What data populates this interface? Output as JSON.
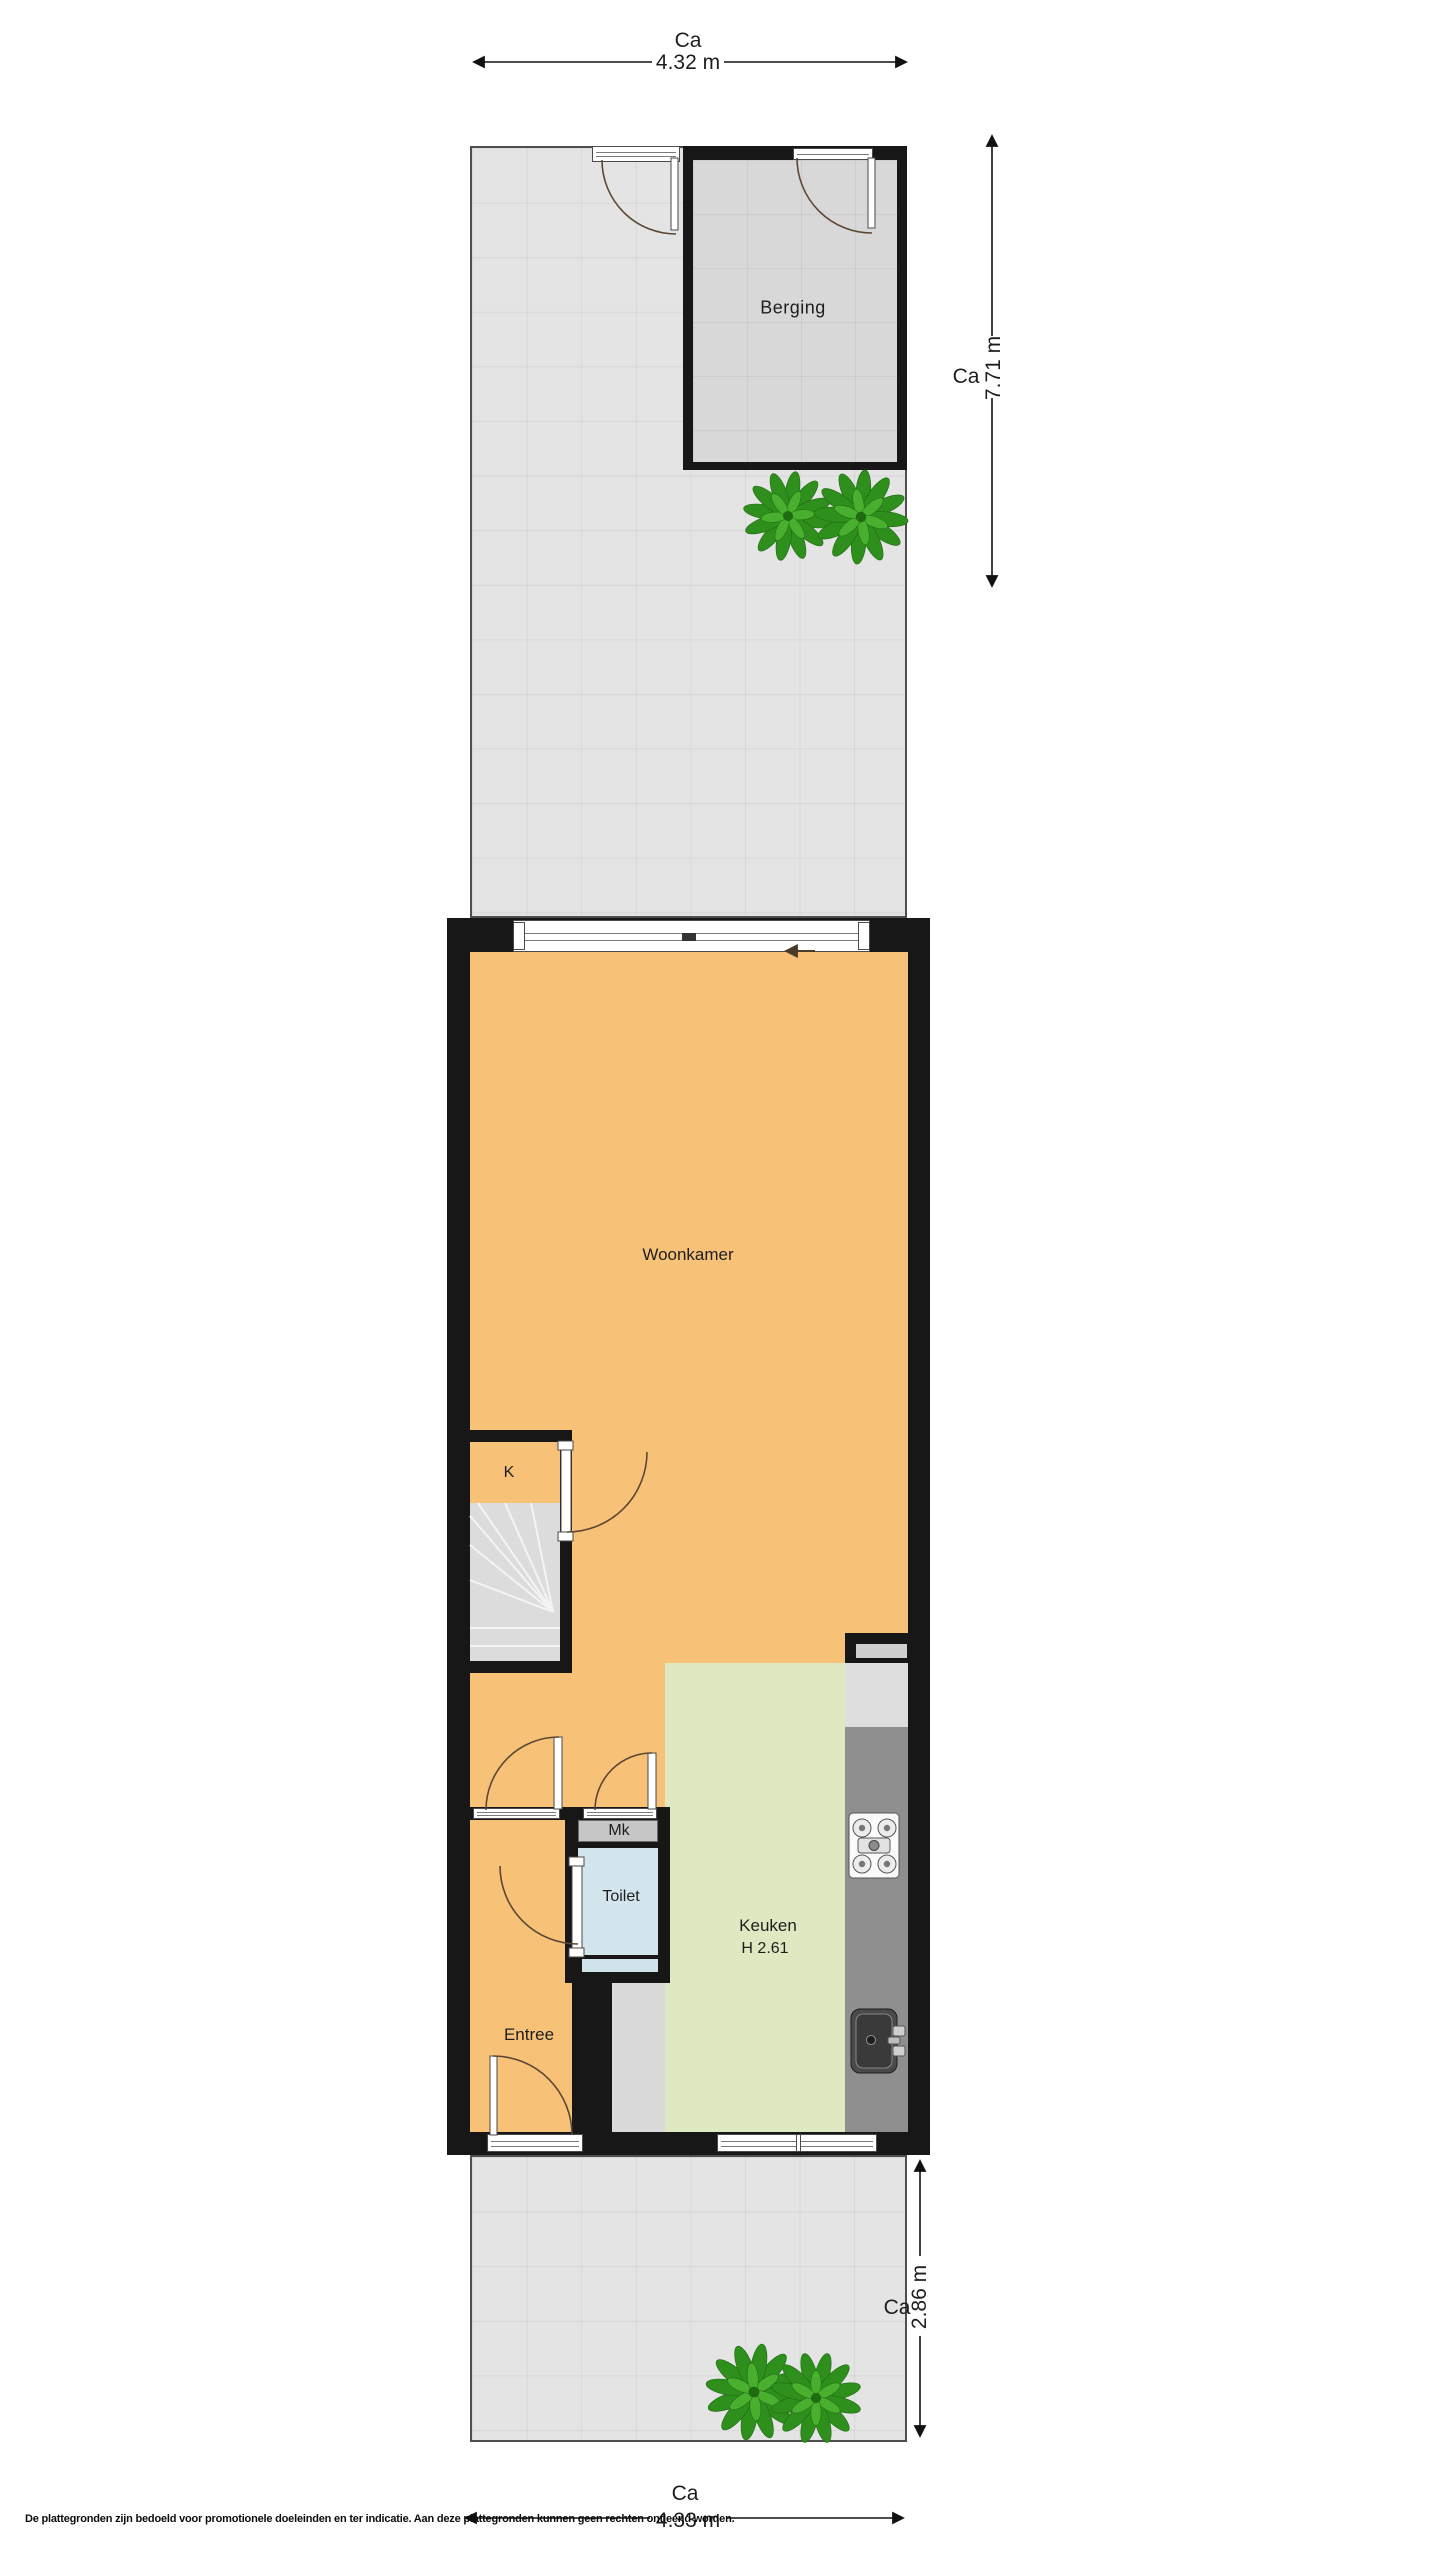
{
  "rooms": {
    "berging": "Berging",
    "woonkamer": "Woonkamer",
    "kast": "K",
    "meterkast": "Mk",
    "toilet": "Toilet",
    "keuken": "Keuken",
    "keuken_hoogte": "H 2.61",
    "entree": "Entree"
  },
  "dimensions": {
    "garden_top_width": {
      "prefix": "Ca",
      "value": "4.32 m"
    },
    "garden_top_depth": {
      "prefix": "Ca",
      "value": "7.71 m"
    },
    "garden_bottom_depth": {
      "prefix": "Ca",
      "value": "2.86 m"
    },
    "garden_bottom_width": {
      "prefix": "Ca",
      "value": "4.33 m"
    }
  },
  "disclaimer": "De plattegronden zijn bedoeld voor promotionele doeleinden en ter indicatie. Aan deze plattegronden kunnen geen rechten ontleend worden.",
  "colors": {
    "wall": "#171717",
    "living": "#F7C278",
    "kitchen": "#DFE9C1",
    "toilet_floor": "#D2E4EC",
    "garden_tile": "#E4E4E4",
    "berging_floor": "#D8D8D8",
    "stairs": "#DCDCDC",
    "hall_floor": "#DADADA",
    "meter_cupboard": "#C6C6C6",
    "counter": "#8F8F8F",
    "appliance": "#DEDEDE",
    "plant_dark": "#1E6B10",
    "plant_mid": "#2F8F1D",
    "plant_light": "#49B02F",
    "door_arc": "#5C4733",
    "text": "#1E1E1E"
  }
}
